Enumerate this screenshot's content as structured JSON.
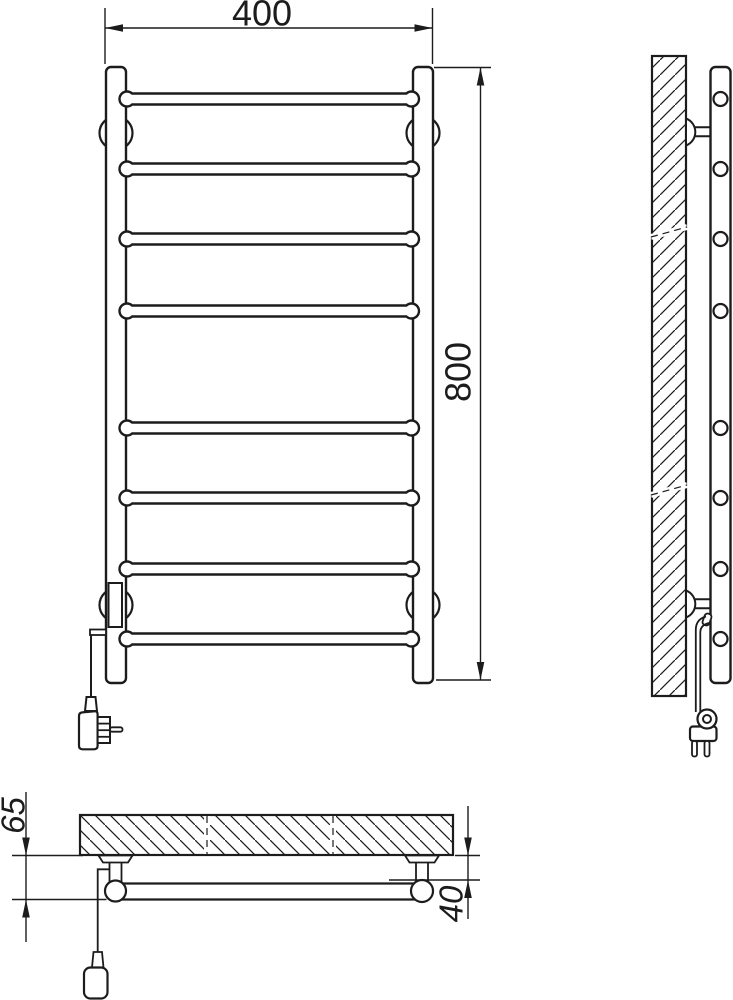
{
  "dimensions": {
    "width": {
      "value": "400",
      "label_style": "upright"
    },
    "height": {
      "value": "800",
      "label_style": "upright"
    },
    "depth": {
      "value": "65",
      "label_style": "italic"
    },
    "offset": {
      "value": "40",
      "label_style": "italic"
    }
  },
  "colors": {
    "line": "#1c1c1c",
    "background": "#ffffff"
  }
}
